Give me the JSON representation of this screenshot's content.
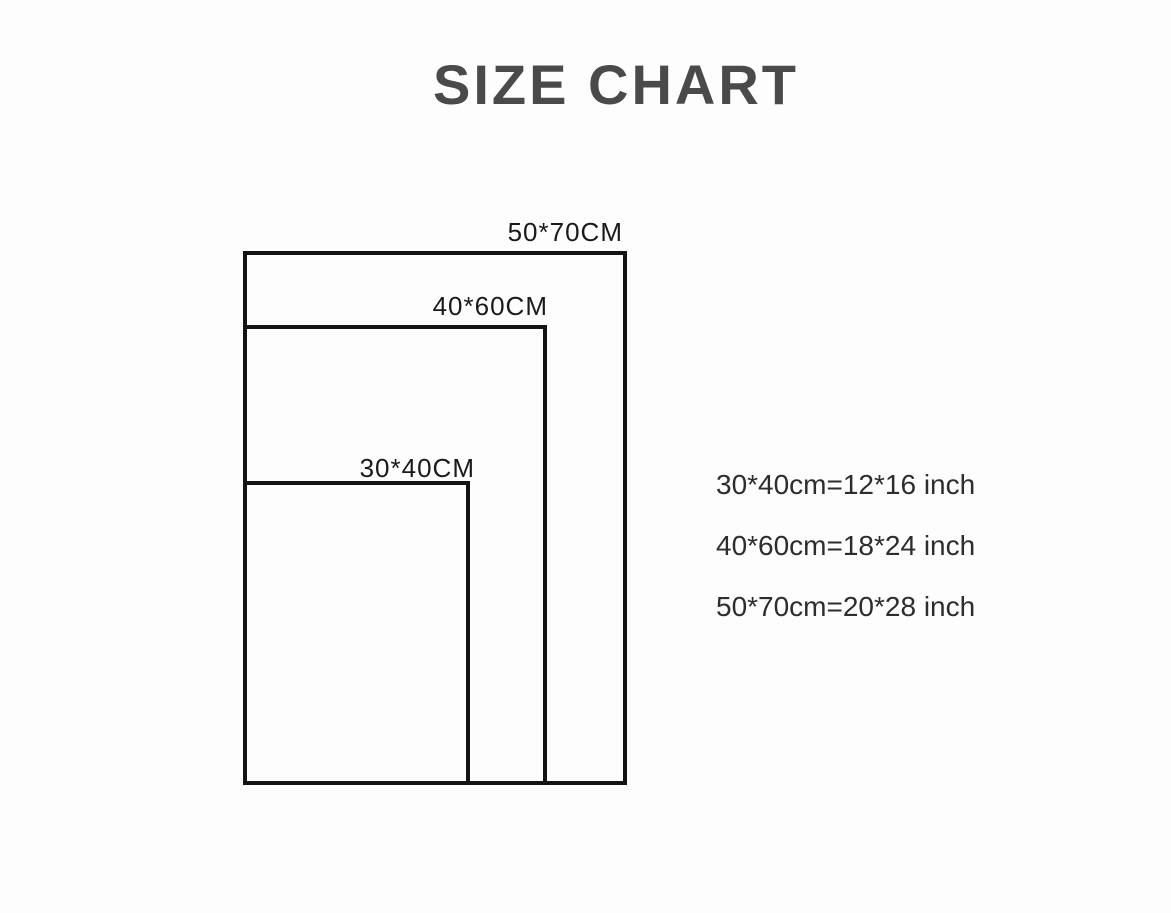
{
  "title": "SIZE CHART",
  "colors": {
    "background": "#fdfdfd",
    "title_text": "#4a4a4a",
    "line": "#141414",
    "label_text": "#1a1a1a",
    "conversion_text": "#2d2d2d"
  },
  "diagram": {
    "rectangles": [
      {
        "id": "50x70",
        "label": "50*70CM"
      },
      {
        "id": "40x60",
        "label": "40*60CM"
      },
      {
        "id": "30x40",
        "label": "30*40CM"
      }
    ]
  },
  "conversions": [
    {
      "text": "30*40cm=12*16 inch"
    },
    {
      "text": "40*60cm=18*24 inch"
    },
    {
      "text": "50*70cm=20*28 inch"
    }
  ]
}
